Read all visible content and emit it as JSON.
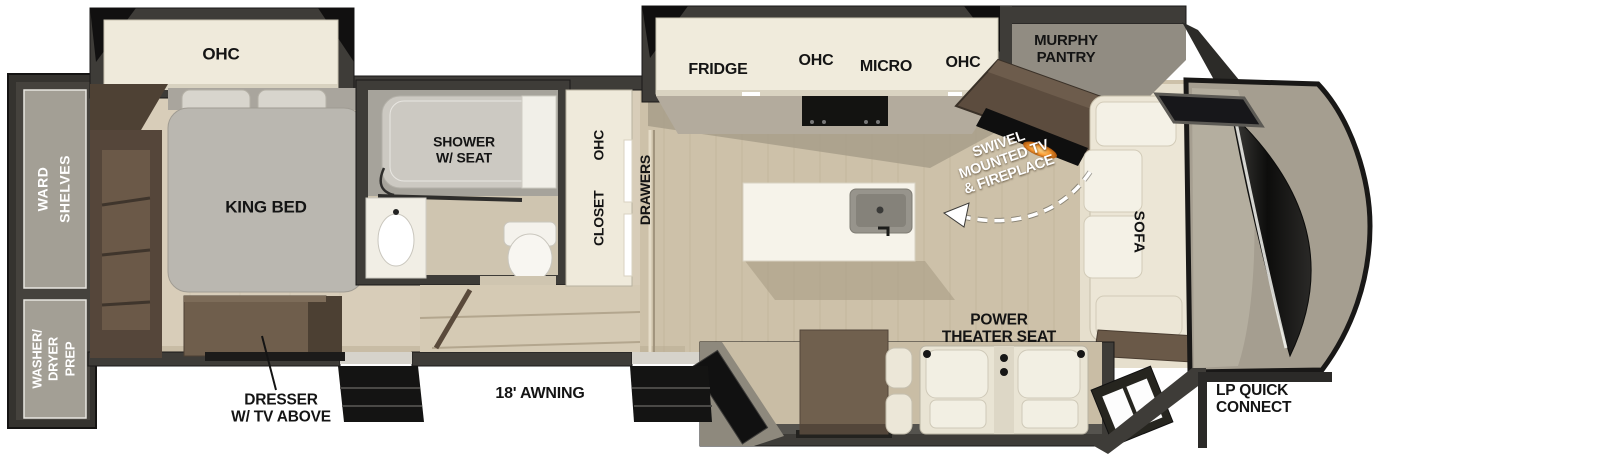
{
  "title": "Fifth Wheel RV Floorplan",
  "rear": {
    "ward_shelves": "WARD\nSHELVES",
    "washer_dryer_prep": "WASHER/\nDRYER\nPREP"
  },
  "bedroom": {
    "ohc": "OHC",
    "king_bed": "KING BED",
    "dresser": "DRESSER\nW/ TV ABOVE"
  },
  "bathroom": {
    "shower": "SHOWER\nW/ SEAT"
  },
  "hall": {
    "closet": "CLOSET",
    "closet_ohc": "OHC",
    "drawers": "DRAWERS"
  },
  "kitchen": {
    "fridge": "FRIDGE",
    "ohc_left": "OHC",
    "micro": "MICRO",
    "ohc_right": "OHC",
    "murphy_pantry": "MURPHY\nPANTRY"
  },
  "living": {
    "swivel_tv": "SWIVEL\nMOUNTED TV\n& FIREPLACE",
    "sofa": "SOFA",
    "power_theater_seat": "POWER\nTHEATER SEAT"
  },
  "exterior": {
    "awning": "18' AWNING",
    "lp_quick_connect": "LP QUICK\nCONNECT"
  },
  "colors": {
    "wall": "#3e3c38",
    "floor_main": "#cdc1a9",
    "floor_bedroom": "#d8cdb9",
    "cabinet_cream": "#efeadb",
    "furniture_brown": "#6f5e4c",
    "bed_gray": "#bab7b0",
    "accent_flame": "#ffae3c",
    "cap_gray": "#a59e90",
    "windshield_dark": "#111110"
  }
}
